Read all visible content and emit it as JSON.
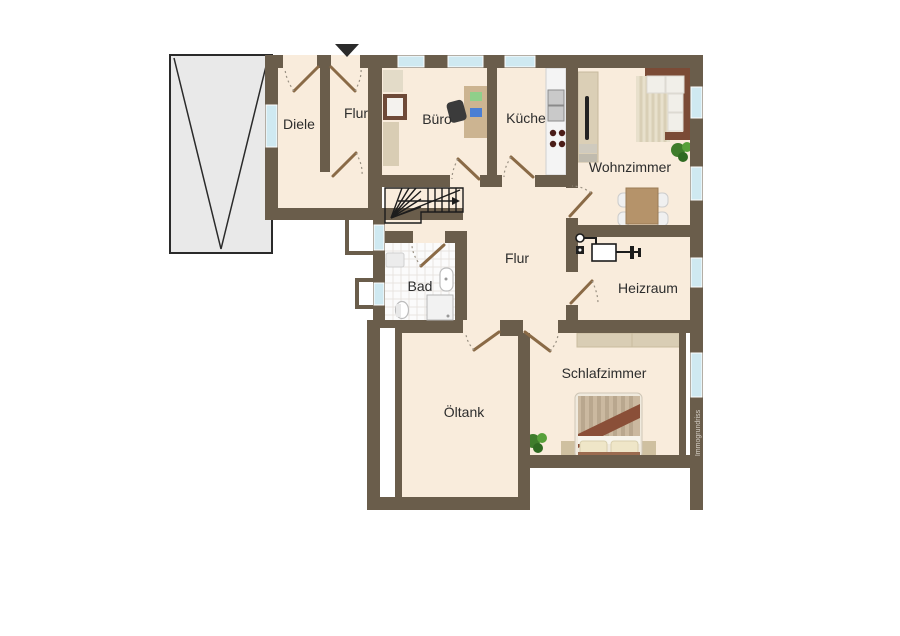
{
  "rooms": {
    "diele": "Diele",
    "flur_top": "Flur",
    "buero": "Büro",
    "kueche": "Küche",
    "wohnzimmer": "Wohnzimmer",
    "heizraum": "Heizraum",
    "bad": "Bad",
    "flur_mitte": "Flur",
    "oeltank": "Öltank",
    "schlafzimmer": "Schlafzimmer"
  },
  "watermark": "Immogrundriss",
  "colors": {
    "wall": "#6a5d4b",
    "room": "#f9ecdc",
    "window": "#cfe9f1",
    "garage": "#e9e9e9",
    "door": "#8a6a46"
  }
}
